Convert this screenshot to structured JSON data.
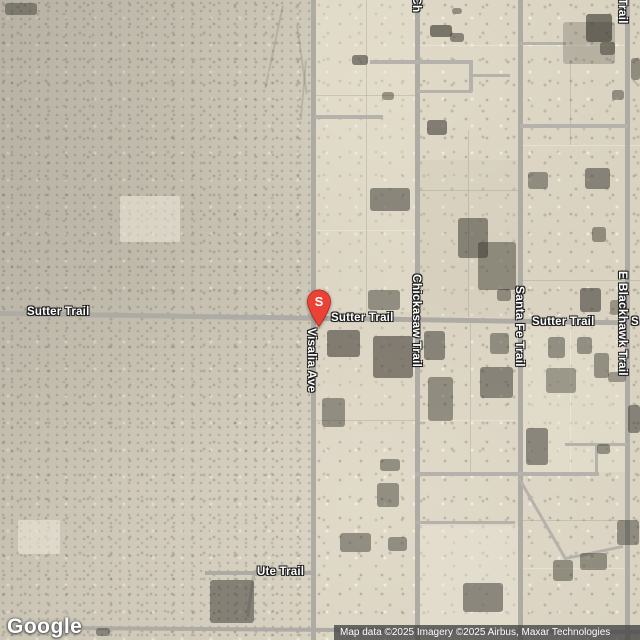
{
  "map": {
    "marker": {
      "label": "S",
      "color": "#EA4335",
      "stroke": "#B3251E",
      "tip_x": 319,
      "tip_y": 330
    },
    "road_labels": {
      "horizontal": [
        {
          "name": "sutter-trail-west",
          "text": "Sutter Trail",
          "x": 27,
          "y": 305
        },
        {
          "name": "sutter-trail-center",
          "text": "Sutter Trail",
          "x": 331,
          "y": 311
        },
        {
          "name": "sutter-trail-east",
          "text": "Sutter Trail",
          "x": 532,
          "y": 315
        },
        {
          "name": "sutter-trail-edge",
          "text": "S",
          "x": 631,
          "y": 315
        },
        {
          "name": "ute-trail",
          "text": "Ute Trail",
          "x": 257,
          "y": 565
        }
      ],
      "vertical": [
        {
          "name": "visalia-ave",
          "text": "Visalia Ave",
          "x": 319,
          "y": 328
        },
        {
          "name": "chickasaw-trail",
          "text": "Chickasaw Trail",
          "x": 424,
          "y": 274
        },
        {
          "name": "santa-fe-trail",
          "text": "Santa Fe Trail",
          "x": 527,
          "y": 286
        },
        {
          "name": "e-blackhawk-trail",
          "text": "E Blackhawk Trail",
          "x": 630,
          "y": 271
        },
        {
          "name": "chickasaw-trail-top",
          "text": "Ch",
          "x": 424,
          "y": -4
        },
        {
          "name": "santa-fe-trail-top",
          "text": "l",
          "x": 526,
          "y": -7
        },
        {
          "name": "e-blackhawk-trail-top",
          "text": "Trail",
          "x": 630,
          "y": -2
        }
      ]
    },
    "roads": {
      "major": [
        {
          "x": -2,
          "y": 311,
          "w": 646,
          "h": 5,
          "rot": 0.85
        },
        {
          "x": 311,
          "y": 0,
          "w": 5,
          "h": 640
        },
        {
          "x": 415,
          "y": 0,
          "w": 5,
          "h": 640
        },
        {
          "x": 518,
          "y": 0,
          "w": 5,
          "h": 640
        },
        {
          "x": 625,
          "y": 0,
          "w": 5,
          "h": 640
        },
        {
          "x": 56,
          "y": 626,
          "w": 586,
          "h": 4,
          "rot": 0.4
        },
        {
          "x": 205,
          "y": 571,
          "w": 110,
          "h": 4
        }
      ],
      "minor": [
        {
          "x": 370,
          "y": 60,
          "w": 103,
          "h": 4
        },
        {
          "x": 469,
          "y": 62,
          "w": 4,
          "h": 30
        },
        {
          "x": 417,
          "y": 90,
          "w": 55,
          "h": 3
        },
        {
          "x": 472,
          "y": 74,
          "w": 38,
          "h": 3
        },
        {
          "x": 315,
          "y": 115,
          "w": 68,
          "h": 4
        },
        {
          "x": 520,
          "y": 42,
          "w": 46,
          "h": 3
        },
        {
          "x": 520,
          "y": 124,
          "w": 108,
          "h": 4
        },
        {
          "x": 415,
          "y": 472,
          "w": 184,
          "h": 4
        },
        {
          "x": 415,
          "y": 521,
          "w": 100,
          "h": 3
        },
        {
          "x": 565,
          "y": 443,
          "w": 62,
          "h": 3
        },
        {
          "x": 595,
          "y": 445,
          "w": 3,
          "h": 30
        },
        {
          "x": 520,
          "y": 477,
          "w": 95,
          "h": 3,
          "rot": 60
        },
        {
          "x": 566,
          "y": 557,
          "w": 58,
          "h": 3,
          "rot": -12
        },
        {
          "x": 252,
          "y": 575,
          "w": 3,
          "h": 42,
          "rot": 8
        }
      ]
    },
    "parcels": [
      {
        "x": 316,
        "y": 0,
        "w": 99,
        "h": 312,
        "c": "rgba(231,225,209,.35)"
      },
      {
        "x": 420,
        "y": 160,
        "w": 98,
        "h": 157,
        "c": "rgba(210,202,182,.30)"
      },
      {
        "x": 316,
        "y": 322,
        "w": 99,
        "h": 120,
        "c": "rgba(226,219,201,.35)"
      },
      {
        "x": 520,
        "y": 322,
        "w": 105,
        "h": 150,
        "c": "rgba(233,227,211,.40)"
      },
      {
        "x": 420,
        "y": 526,
        "w": 98,
        "h": 114,
        "c": "rgba(236,230,214,.40)"
      }
    ],
    "parcel_lines": [
      {
        "x": 420,
        "y": 45,
        "w": 205,
        "h": 1,
        "dk": false
      },
      {
        "x": 316,
        "y": 95,
        "w": 100,
        "h": 1,
        "dk": true
      },
      {
        "x": 520,
        "y": 145,
        "w": 120,
        "h": 1,
        "dk": false
      },
      {
        "x": 420,
        "y": 190,
        "w": 98,
        "h": 1,
        "dk": true
      },
      {
        "x": 316,
        "y": 230,
        "w": 100,
        "h": 1,
        "dk": false
      },
      {
        "x": 520,
        "y": 280,
        "w": 120,
        "h": 1,
        "dk": true
      },
      {
        "x": 316,
        "y": 420,
        "w": 100,
        "h": 1,
        "dk": true
      },
      {
        "x": 420,
        "y": 420,
        "w": 98,
        "h": 1,
        "dk": false
      },
      {
        "x": 520,
        "y": 520,
        "w": 105,
        "h": 1,
        "dk": true
      },
      {
        "x": 520,
        "y": 568,
        "w": 105,
        "h": 1,
        "dk": false
      },
      {
        "x": 366,
        "y": 0,
        "w": 1,
        "h": 312,
        "dk": true
      },
      {
        "x": 468,
        "y": 130,
        "w": 1,
        "h": 187,
        "dk": true
      },
      {
        "x": 570,
        "y": 60,
        "w": 1,
        "h": 85,
        "dk": true
      },
      {
        "x": 470,
        "y": 322,
        "w": 1,
        "h": 150,
        "dk": true
      },
      {
        "x": 570,
        "y": 322,
        "w": 1,
        "h": 150,
        "dk": false
      }
    ],
    "washes": [
      {
        "x": 282,
        "y": 5,
        "w": 2,
        "h": 85,
        "rot": 12
      },
      {
        "x": 296,
        "y": 25,
        "w": 2,
        "h": 70,
        "rot": -8
      },
      {
        "x": 305,
        "y": 60,
        "w": 2,
        "h": 60,
        "rot": 5
      }
    ],
    "pads": [
      {
        "x": 18,
        "y": 520,
        "w": 42,
        "h": 34
      },
      {
        "x": 120,
        "y": 196,
        "w": 60,
        "h": 46
      }
    ],
    "buildings": [
      [
        5,
        3,
        32,
        12,
        0.45
      ],
      [
        352,
        55,
        16,
        10,
        0.55
      ],
      [
        430,
        25,
        22,
        12,
        0.6
      ],
      [
        450,
        33,
        14,
        9,
        0.5
      ],
      [
        452,
        8,
        10,
        6,
        0.45
      ],
      [
        563,
        22,
        52,
        42,
        0.22
      ],
      [
        586,
        14,
        26,
        28,
        0.6
      ],
      [
        600,
        42,
        15,
        13,
        0.5
      ],
      [
        631,
        58,
        9,
        22,
        0.45
      ],
      [
        612,
        90,
        12,
        10,
        0.45
      ],
      [
        427,
        120,
        20,
        15,
        0.55
      ],
      [
        382,
        92,
        12,
        8,
        0.45
      ],
      [
        370,
        188,
        40,
        23,
        0.5
      ],
      [
        458,
        218,
        30,
        40,
        0.5
      ],
      [
        478,
        242,
        38,
        48,
        0.45
      ],
      [
        528,
        172,
        20,
        17,
        0.45
      ],
      [
        585,
        168,
        25,
        21,
        0.5
      ],
      [
        592,
        227,
        14,
        15,
        0.45
      ],
      [
        368,
        290,
        32,
        20,
        0.45
      ],
      [
        580,
        288,
        21,
        24,
        0.55
      ],
      [
        497,
        289,
        14,
        12,
        0.45
      ],
      [
        327,
        330,
        33,
        27,
        0.55
      ],
      [
        373,
        336,
        40,
        42,
        0.55
      ],
      [
        424,
        331,
        21,
        29,
        0.5
      ],
      [
        480,
        367,
        33,
        31,
        0.5
      ],
      [
        546,
        368,
        30,
        25,
        0.4
      ],
      [
        428,
        377,
        25,
        44,
        0.45
      ],
      [
        526,
        428,
        22,
        37,
        0.5
      ],
      [
        597,
        444,
        13,
        10,
        0.45
      ],
      [
        608,
        372,
        18,
        10,
        0.4
      ],
      [
        628,
        405,
        12,
        28,
        0.5
      ],
      [
        380,
        459,
        20,
        12,
        0.45
      ],
      [
        377,
        483,
        22,
        24,
        0.45
      ],
      [
        340,
        533,
        31,
        19,
        0.45
      ],
      [
        388,
        537,
        19,
        14,
        0.45
      ],
      [
        463,
        583,
        40,
        29,
        0.5
      ],
      [
        553,
        560,
        20,
        21,
        0.45
      ],
      [
        580,
        553,
        27,
        17,
        0.45
      ],
      [
        617,
        520,
        22,
        25,
        0.45
      ],
      [
        490,
        333,
        19,
        21,
        0.45
      ],
      [
        548,
        337,
        17,
        21,
        0.45
      ],
      [
        577,
        337,
        15,
        17,
        0.45
      ],
      [
        594,
        353,
        15,
        25,
        0.45
      ],
      [
        322,
        398,
        23,
        29,
        0.45
      ],
      [
        610,
        300,
        17,
        15,
        0.4
      ],
      [
        210,
        580,
        44,
        43,
        0.5
      ],
      [
        96,
        628,
        14,
        8,
        0.45
      ]
    ]
  },
  "attribution": {
    "google": "Google",
    "text": "Map data ©2025 Imagery ©2025 Airbus, Maxar Technologies"
  }
}
